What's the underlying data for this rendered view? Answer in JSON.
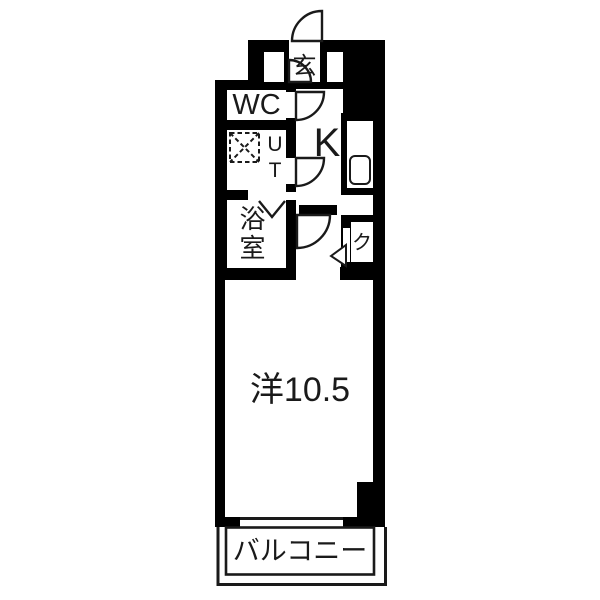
{
  "canvas": {
    "width": 600,
    "height": 600,
    "background": "#ffffff"
  },
  "colors": {
    "wall": "#000000",
    "line": "#1a1a1a",
    "floor": "#ffffff"
  },
  "rooms": {
    "genkan": {
      "label": "玄"
    },
    "wc": {
      "label": "WC"
    },
    "utility": {
      "label": "UT"
    },
    "kitchen": {
      "label": "K"
    },
    "bathroom": {
      "label": "浴室"
    },
    "closet": {
      "label": "ク"
    },
    "main_room": {
      "label": "洋10.5"
    },
    "balcony": {
      "label": "バルコニー"
    }
  },
  "symbols": {
    "entrance_door": "quarter-arc-door-swing",
    "hall_door": "quarter-arc-door-swing",
    "wc_door": "quarter-arc-door-swing",
    "utility_door": "quarter-arc-door-swing",
    "main_room_door": "quarter-arc-door-swing",
    "bathroom_folding_door": "v-chevron-mark",
    "closet_folding_door": "triangle-mark",
    "kitchen_sink": "rounded-rect-basin",
    "washer_pan": "dashed-square-with-x",
    "window": "wall-opening-line",
    "shoe_cabinet": "recessed-slot",
    "pillar": "solid-corner-block"
  }
}
